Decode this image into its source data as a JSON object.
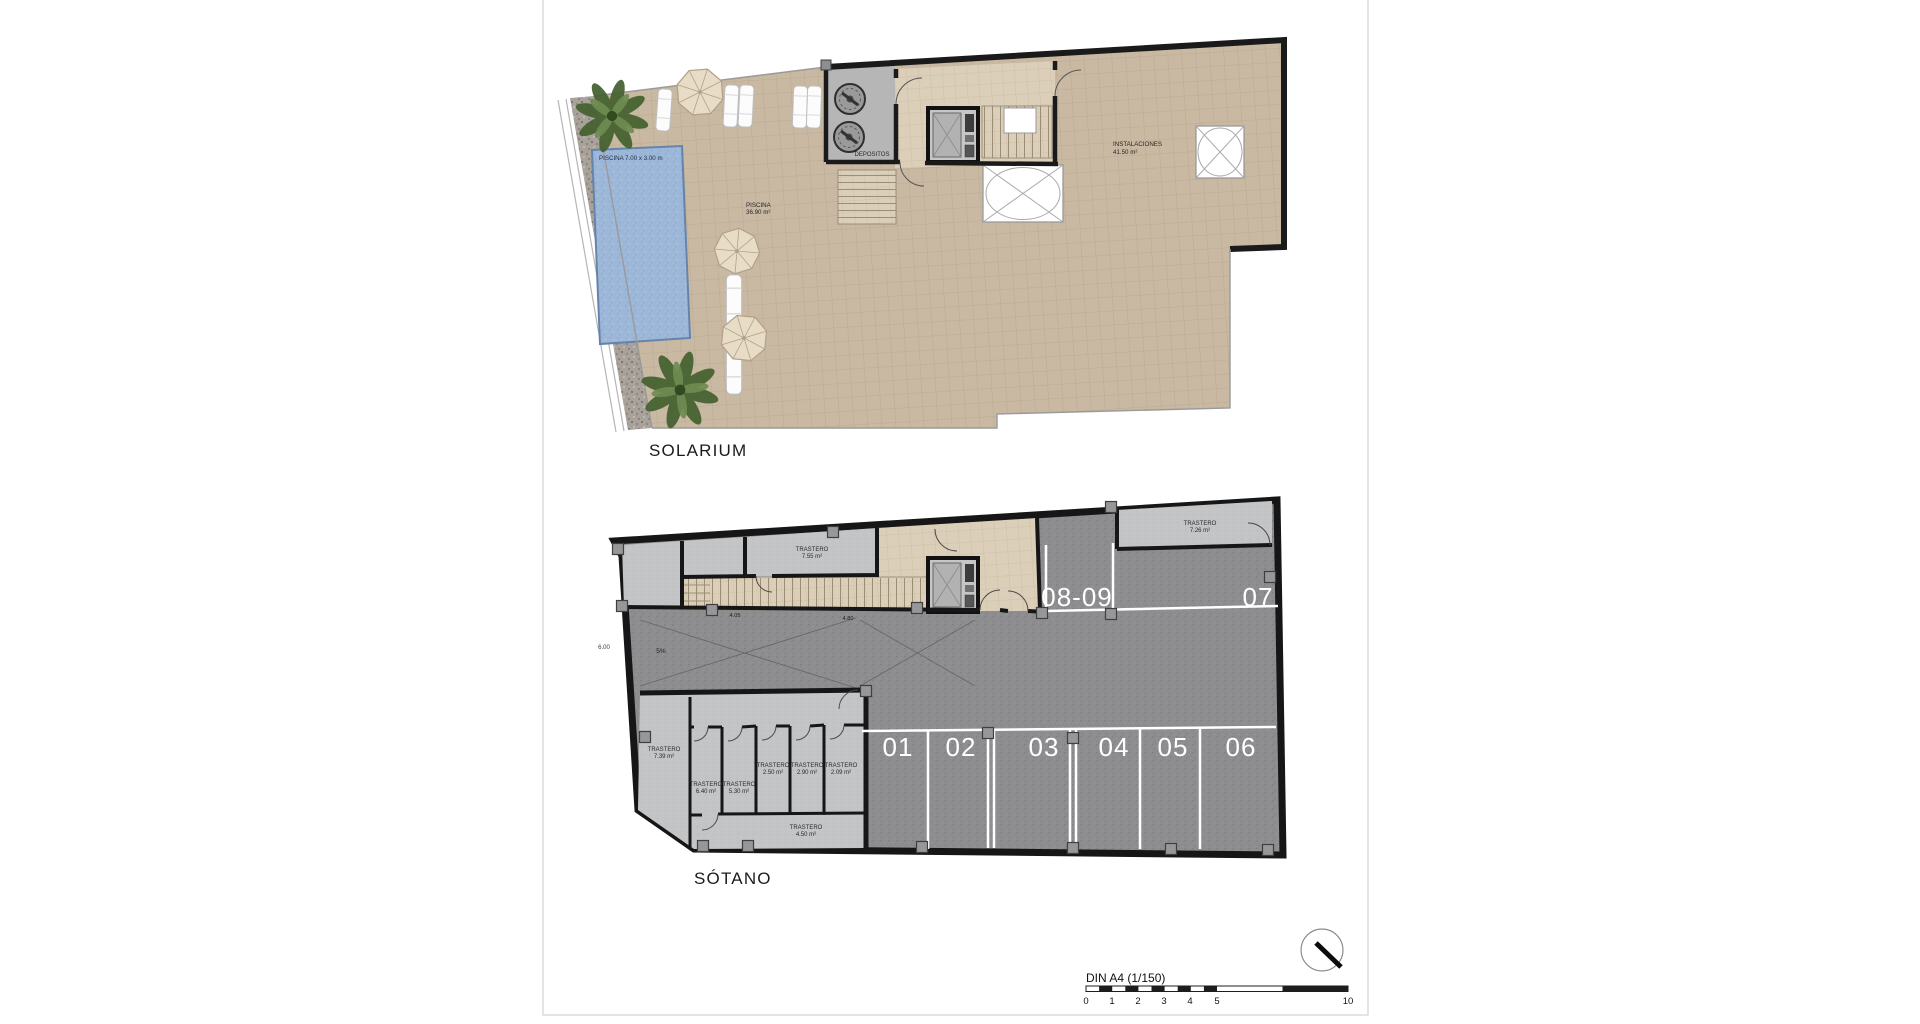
{
  "labels": {
    "sol": {
      "title": "SOLARIUM",
      "pool_dim": "PISCINA 7.00 x 3.00 m",
      "pool1": "PISCINA",
      "pool2": "36.90 m²",
      "depositos": "DEPOSITOS",
      "inst1": "INSTALACIONES",
      "inst2": "41.50 m²"
    },
    "sot": {
      "title": "SÓTANO",
      "grade": "5%",
      "dim_w": "6.00",
      "dim_a": "4.05",
      "dim_b": "4.80",
      "t_top1": "TRASTERO",
      "t_top2": "7.55 m²",
      "t_tr1": "TRASTERO",
      "t_tr2": "7.26 m²",
      "s": [
        {
          "a": "TRASTERO",
          "b": "7.39 m²"
        },
        {
          "a": "TRASTERO",
          "b": "6.40 m²"
        },
        {
          "a": "TRASTERO",
          "b": "5.30 m²"
        },
        {
          "a": "TRASTERO",
          "b": "2.50 m²"
        },
        {
          "a": "TRASTERO",
          "b": "2.90 m²"
        },
        {
          "a": "TRASTERO",
          "b": "2.09 m²"
        },
        {
          "a": "TRASTERO",
          "b": "4.50 m²"
        }
      ],
      "p01": "01",
      "p02": "02",
      "p03": "03",
      "p04": "04",
      "p05": "05",
      "p06": "06",
      "p07": "07",
      "p0809": "08-09"
    },
    "scale": {
      "label": "DIN A4 (1/150)",
      "n0": "0",
      "n1": "1",
      "n2": "2",
      "n3": "3",
      "n4": "4",
      "n5": "5",
      "n10": "10"
    }
  },
  "colors": {
    "wall": "#1a1a1a",
    "terrace_tan": "#c9b8a2",
    "interior_beige": "#dbcfba",
    "pool_water": "#9db7d8",
    "asphalt": "#8d8d8f",
    "storage_room": "#c2c4c6",
    "parking_line": "#ffffff",
    "page_border": "#c9c9c9"
  }
}
